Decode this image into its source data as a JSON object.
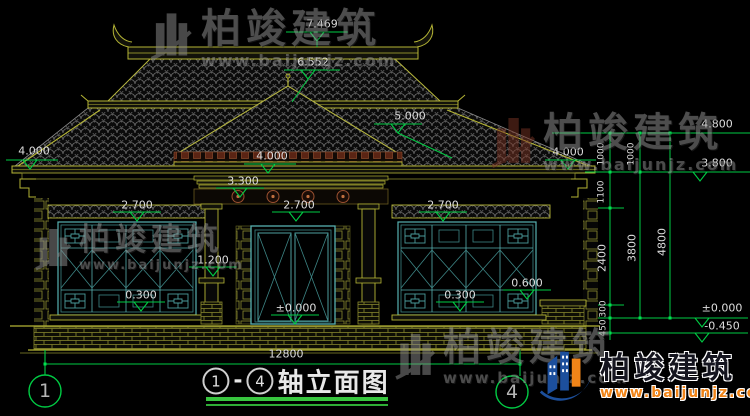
{
  "drawing": {
    "title": {
      "axis_start": "1",
      "dash": "-",
      "axis_end": "4",
      "text": "轴立面图"
    },
    "axis_bubbles": {
      "left": "1",
      "right": "4"
    },
    "elevations": {
      "ridge": "7.469",
      "upper_eave": "6.552",
      "porch_slope": "5.000",
      "eave_left": "4.000",
      "porch_eave": "4.000",
      "eave_right": "4.000",
      "beam": "3.300",
      "window_head_left": "2.700",
      "door_head": "2.700",
      "window_head_right": "2.700",
      "pedestal": "1.200",
      "sill_left": "0.300",
      "sill_right": "0.300",
      "ledge_right": "0.600",
      "ground_center": "±0.000",
      "right_4800": "4.800",
      "right_3800": "3.800",
      "right_zero": "±0.000",
      "right_neg": "-0.450"
    },
    "dimensions": {
      "total_width": "12800",
      "seg_1000a": "1000",
      "seg_1000b": "1000",
      "seg_1100": "1100",
      "seg_2400": "2400",
      "seg_300": "300",
      "seg_450": "450",
      "seg_3800": "3800",
      "seg_4800": "4800"
    },
    "watermark": {
      "name": "柏竣建筑",
      "url": "www.baijunjz.com"
    },
    "logo": {
      "name": "柏竣建筑",
      "url": "www.baijunjz.com"
    },
    "colors": {
      "annotation_green": "#00cc44",
      "cad_yellow": "#b5b535",
      "frame_cyan": "#57b0b0",
      "tile_red": "#5a2414",
      "logo_blue": "#1c4f9c",
      "logo_orange": "#f08418",
      "watermark_gray": "#9a9a9a"
    }
  }
}
